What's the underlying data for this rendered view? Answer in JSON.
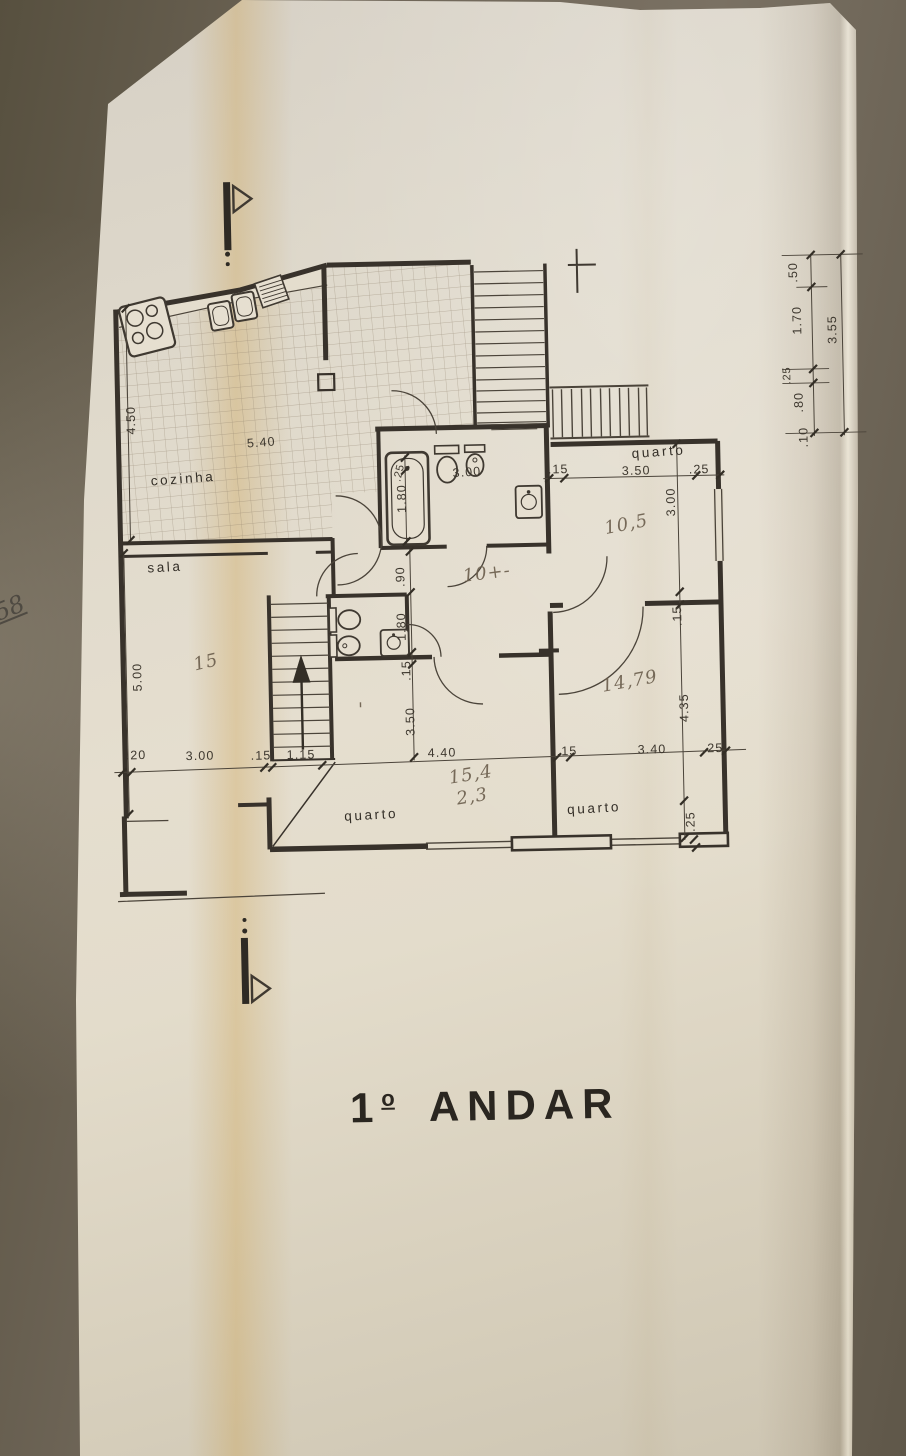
{
  "title": {
    "number": "1",
    "ordinal": "o",
    "word": "ANDAR"
  },
  "margin_note": "58",
  "rooms": [
    {
      "name": "cozinha",
      "location": "top-left"
    },
    {
      "name": "sala",
      "location": "left"
    },
    {
      "name": "quarto",
      "location": "top-right"
    },
    {
      "name": "quarto",
      "location": "bottom-middle"
    },
    {
      "name": "quarto",
      "location": "bottom-right"
    }
  ],
  "dimension_chains": {
    "bottom_horizontal": [
      ".20",
      "3.00",
      ".15",
      "1.15",
      "4.40",
      ".15",
      "3.40",
      ".25"
    ],
    "left_vertical": [
      "4.50",
      "5.00"
    ],
    "kitchen_width": "5.40",
    "right_side_chain": [
      ".50",
      "1.70",
      ".25",
      ".80",
      ".10"
    ],
    "right_side_total": "3.55",
    "bathroom": [
      ".25",
      "1.80",
      "3.00",
      ".15",
      ".90"
    ],
    "wc": [
      "1.80",
      ".15"
    ],
    "quarto_top_right": [
      ".15",
      "3.50",
      ".25",
      "3.00"
    ],
    "quarto_bottom_right": [
      ".15",
      "3.40",
      ".25",
      "4.35",
      ".25"
    ],
    "quarto_bottom_middle": [
      "3.50"
    ]
  },
  "handwritten_areas": [
    "15",
    "10,5",
    "10+-",
    "14,79",
    "15,4",
    "2,3"
  ],
  "plan": {
    "labels": [
      {
        "t": "4.50",
        "x": 138,
        "y": 414,
        "r": -90,
        "c": "dim"
      },
      {
        "t": "5.40",
        "x": 264,
        "y": 443,
        "r": -3,
        "c": "dim"
      },
      {
        "t": "cozinha",
        "x": 185,
        "y": 478,
        "r": -3,
        "c": "room"
      },
      {
        "t": "sala",
        "x": 165,
        "y": 566,
        "r": -2,
        "c": "room"
      },
      {
        "t": "5.00",
        "x": 139,
        "y": 671,
        "r": -90,
        "c": "dim"
      },
      {
        "t": "15",
        "x": 205,
        "y": 663,
        "r": -12,
        "c": "hand"
      },
      {
        "t": ".25",
        "x": 404,
        "y": 473,
        "r": -75,
        "c": "dimS"
      },
      {
        "t": "1.80",
        "x": 407,
        "y": 498,
        "r": -90,
        "c": "dim"
      },
      {
        "t": "3.00",
        "x": 469,
        "y": 477,
        "r": -3,
        "c": "dim"
      },
      {
        "t": ".15",
        "x": 560,
        "y": 476,
        "r": 0,
        "c": "dim"
      },
      {
        "t": "quarto",
        "x": 661,
        "y": 461,
        "r": -3,
        "c": "room"
      },
      {
        "t": "3.50",
        "x": 638,
        "y": 479,
        "r": 0,
        "c": "dim"
      },
      {
        "t": ".25",
        "x": 701,
        "y": 479,
        "r": 0,
        "c": "dim"
      },
      {
        "t": "3.00",
        "x": 676,
        "y": 507,
        "r": -90,
        "c": "dim"
      },
      {
        "t": "10,5",
        "x": 628,
        "y": 534,
        "r": -10,
        "c": "hand"
      },
      {
        "t": ".90",
        "x": 404,
        "y": 576,
        "r": -90,
        "c": "dim"
      },
      {
        "t": "10+-",
        "x": 487,
        "y": 580,
        "r": -6,
        "c": "hand"
      },
      {
        "t": "1.80",
        "x": 404,
        "y": 626,
        "r": -90,
        "c": "dim"
      },
      {
        "t": ".15",
        "x": 408,
        "y": 670,
        "r": -90,
        "c": "dim"
      },
      {
        "t": ".15",
        "x": 680,
        "y": 621,
        "r": -90,
        "c": "dim"
      },
      {
        "t": "14,79",
        "x": 628,
        "y": 691,
        "r": -9,
        "c": "hand"
      },
      {
        "t": "4.35",
        "x": 685,
        "y": 713,
        "r": -90,
        "c": "dim"
      },
      {
        "t": "3.50",
        "x": 411,
        "y": 721,
        "r": -90,
        "c": "dim"
      },
      {
        "t": "'",
        "x": 358,
        "y": 714,
        "r": 0,
        "c": "hand"
      },
      {
        "t": ".20",
        "x": 132,
        "y": 753,
        "r": 0,
        "c": "dim"
      },
      {
        "t": "3.00",
        "x": 196,
        "y": 755,
        "r": 0,
        "c": "dim"
      },
      {
        "t": ".15",
        "x": 257,
        "y": 756,
        "r": 0,
        "c": "dim"
      },
      {
        "t": "1.15",
        "x": 297,
        "y": 756,
        "r": 0,
        "c": "dim"
      },
      {
        "t": "4.40",
        "x": 438,
        "y": 757,
        "r": 0,
        "c": "dim"
      },
      {
        "t": ".15",
        "x": 563,
        "y": 758,
        "r": 0,
        "c": "dim"
      },
      {
        "t": "3.40",
        "x": 648,
        "y": 758,
        "r": 0,
        "c": "dim"
      },
      {
        "t": ".25",
        "x": 709,
        "y": 758,
        "r": 0,
        "c": "dim"
      },
      {
        "t": "15,4",
        "x": 467,
        "y": 781,
        "r": -8,
        "c": "hand"
      },
      {
        "t": "2,3",
        "x": 468,
        "y": 803,
        "r": -8,
        "c": "hand"
      },
      {
        "t": "quarto",
        "x": 366,
        "y": 818,
        "r": -2,
        "c": "room"
      },
      {
        "t": "quarto",
        "x": 589,
        "y": 816,
        "r": -2,
        "c": "room"
      },
      {
        "t": ".25",
        "x": 689,
        "y": 827,
        "r": -90,
        "c": "dim"
      },
      {
        "t": ".50",
        "x": 803,
        "y": 280,
        "r": -90,
        "c": "dim"
      },
      {
        "t": "1.70",
        "x": 806,
        "y": 328,
        "r": -90,
        "c": "dim"
      },
      {
        "t": "3.55",
        "x": 841,
        "y": 338,
        "r": -90,
        "c": "dim"
      },
      {
        "t": ".25",
        "x": 794,
        "y": 383,
        "r": -90,
        "c": "dimS"
      },
      {
        "t": ".80",
        "x": 806,
        "y": 410,
        "r": -90,
        "c": "dim"
      },
      {
        "t": ".10",
        "x": 810,
        "y": 445,
        "r": -90,
        "c": "dim"
      }
    ]
  }
}
